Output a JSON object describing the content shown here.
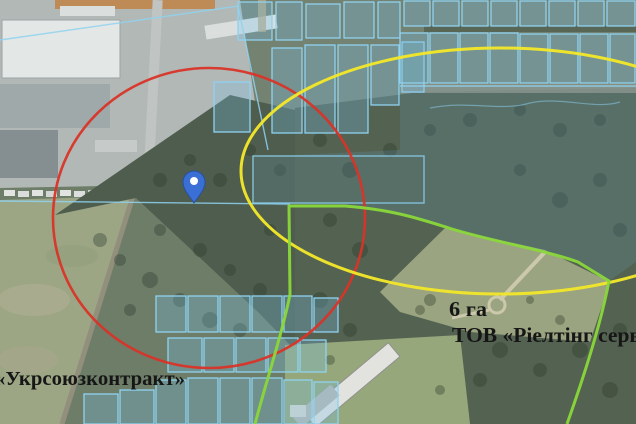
{
  "map": {
    "labels": {
      "left_company": "«Укрсоюзконтракт»",
      "plot_area": "6 га",
      "right_company": "ТОВ «Ріелтінг серві"
    },
    "icons": {
      "marker": "map-pin"
    },
    "colors": {
      "red_zone": "#d93428",
      "yellow_zone": "#f2e62a",
      "green_boundary": "#8ad83a",
      "parcel_blue": "#8fd2f0",
      "parcel_fill": "rgba(120,195,235,0.28)",
      "overlay_tint": "rgba(110,180,225,0.16)",
      "pin_fill": "#3a6fd6",
      "pin_border": "#27509e",
      "label_text": "#161616"
    }
  }
}
